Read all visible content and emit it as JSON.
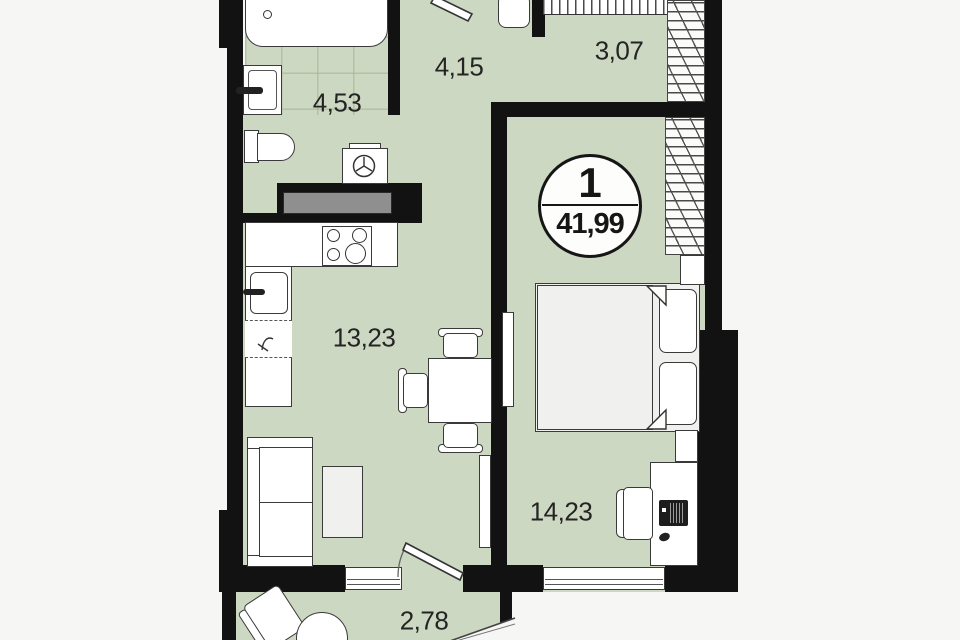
{
  "floor_plan": {
    "unit_badge": {
      "unit_number": "1",
      "total_area": "41,99"
    },
    "room_areas": {
      "bathroom": "4,53",
      "hallway": "4,15",
      "wardrobe": "3,07",
      "kitchen_living_room": "13,23",
      "bedroom": "14,23",
      "balcony": "2,78"
    },
    "colors": {
      "room_fill": "#cdd8c2",
      "wall": "#121212",
      "background": "#f6f6f5",
      "vent_gray": "#8f8f8f",
      "furniture_outline": "#3a3a3a"
    }
  }
}
